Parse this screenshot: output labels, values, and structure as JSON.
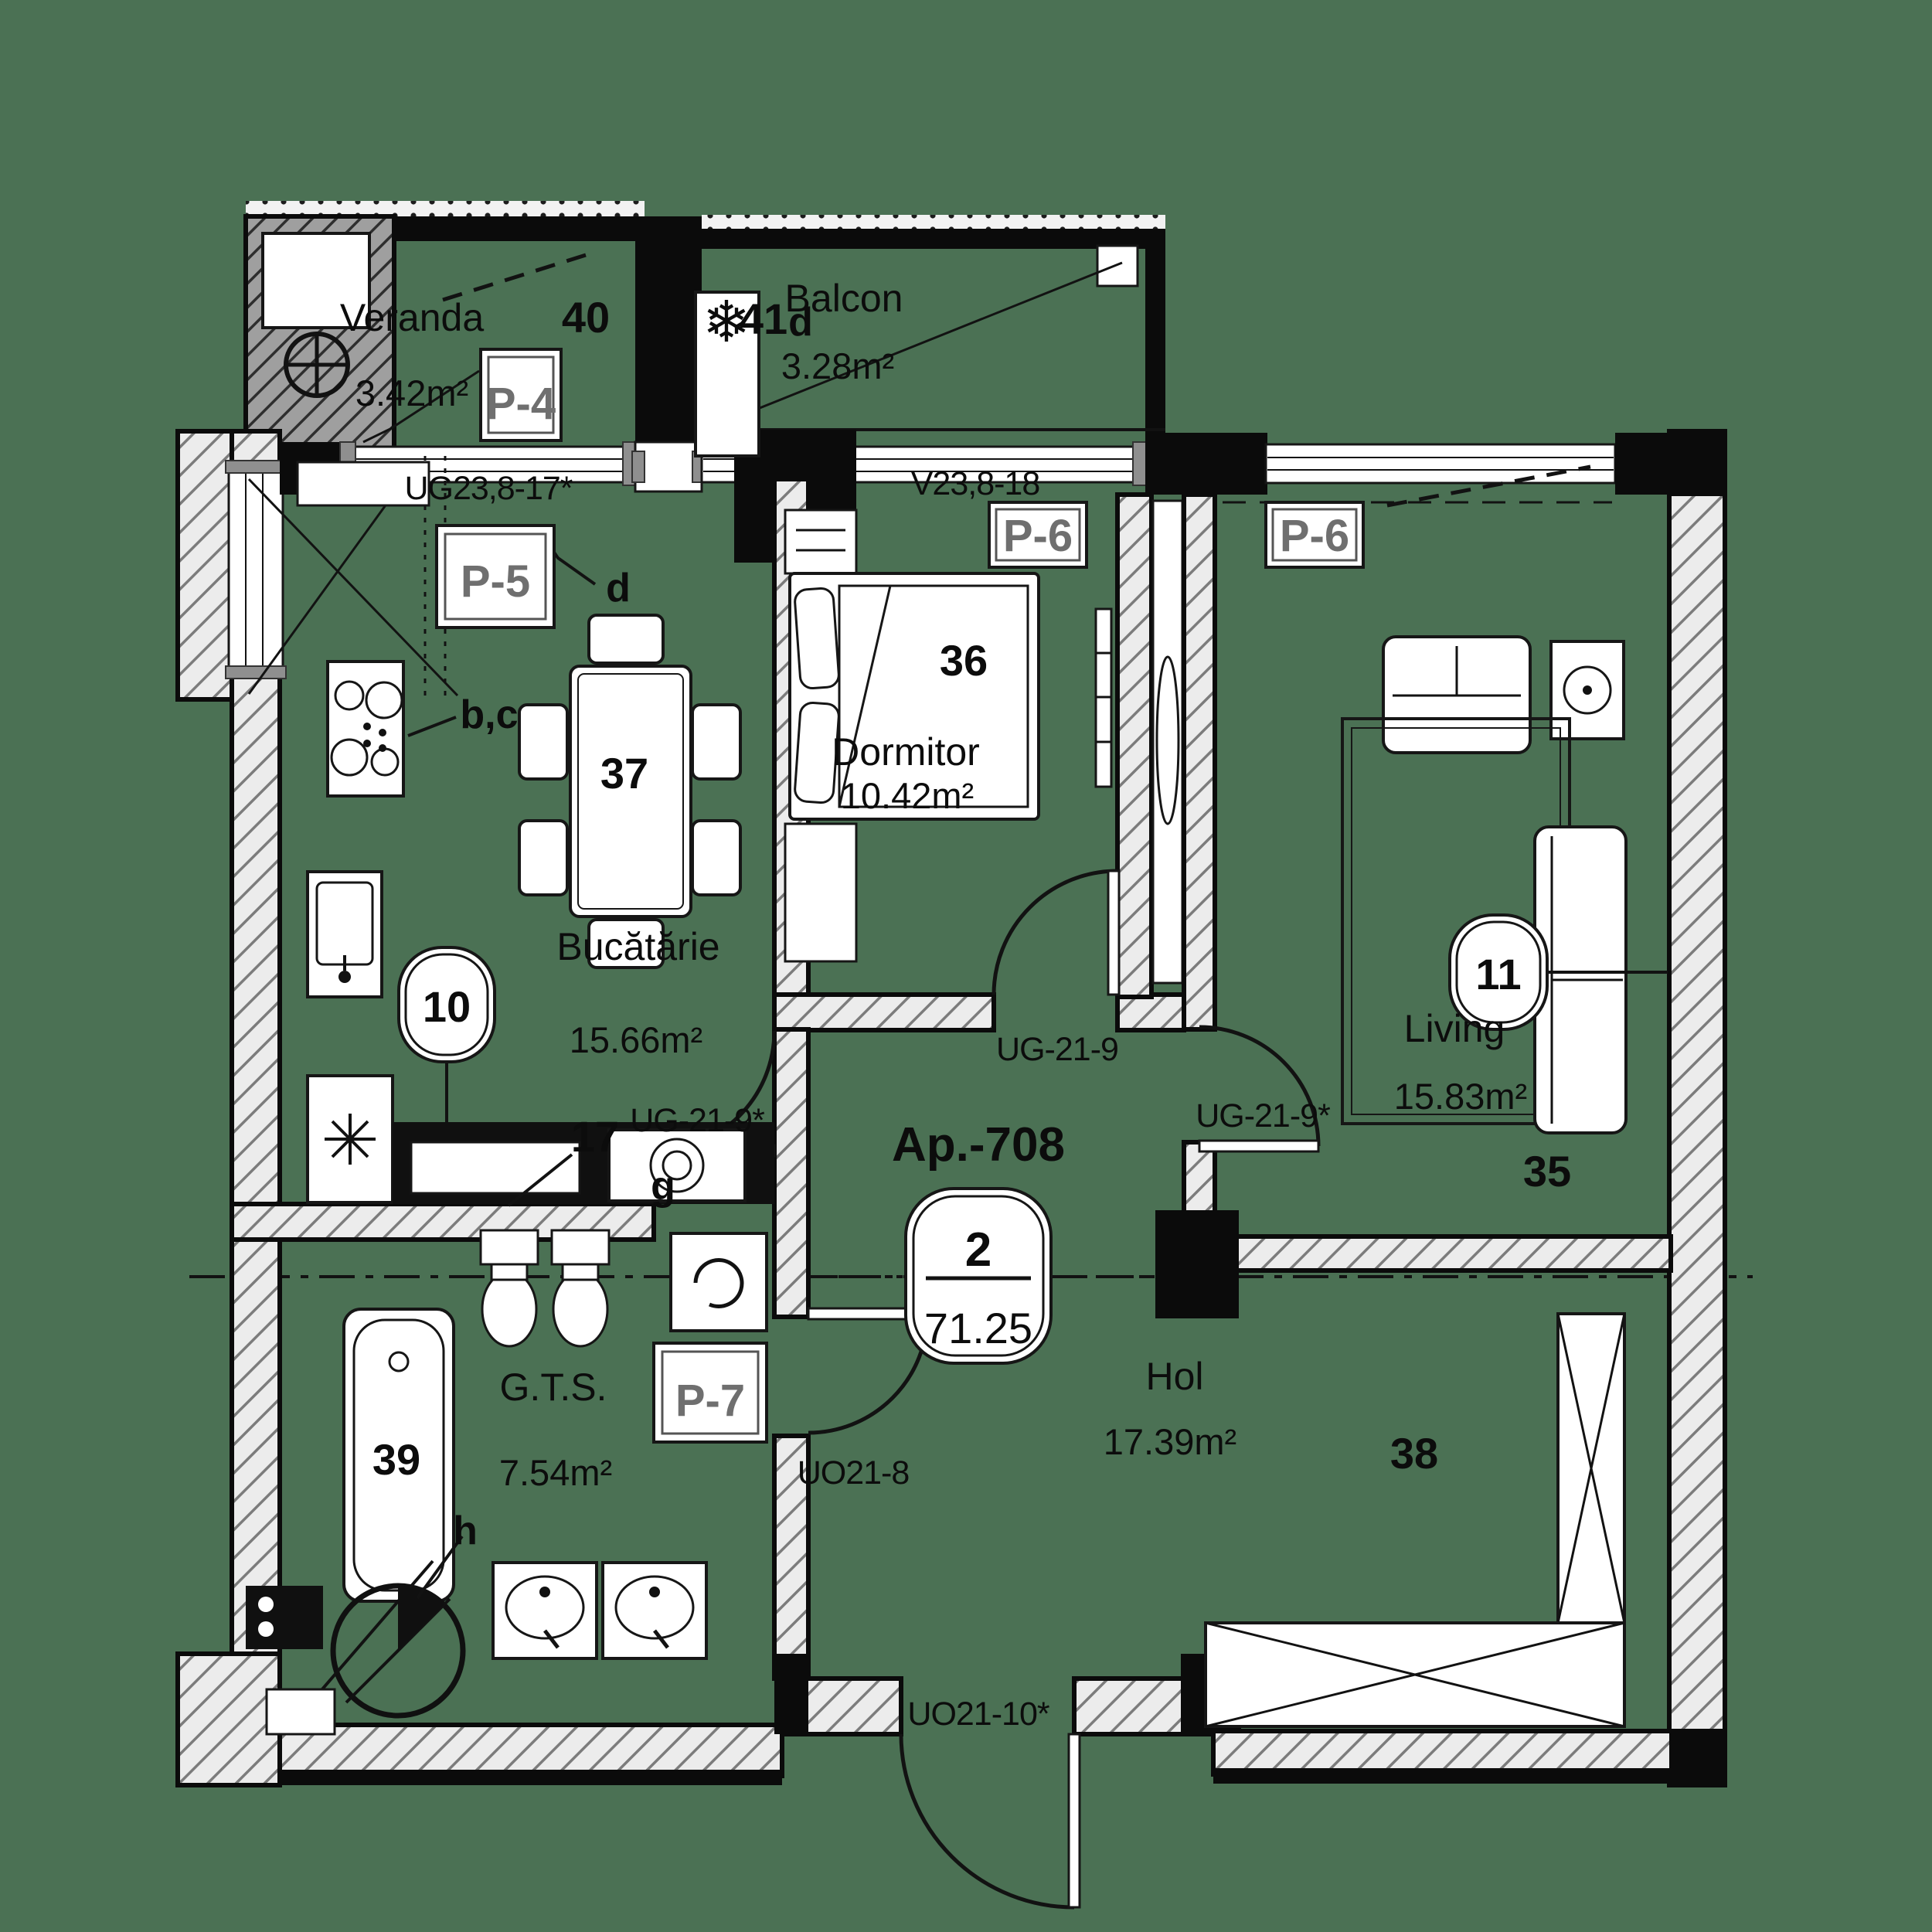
{
  "colors": {
    "background": "#4b7154",
    "ink": "#0c0c0c",
    "panel_text": "#6f6f6f"
  },
  "apartment_stamp": {
    "id": "Ap.-708",
    "rooms_count": "2",
    "total_area": "71.25"
  },
  "rooms": [
    {
      "name": "Veranda",
      "area": "3.42m²",
      "number": "40",
      "panel": "P-4"
    },
    {
      "name": "Balcon",
      "area": "3.28m²",
      "number": "41",
      "finish": "d"
    },
    {
      "name": "Bucătărie",
      "area": "15.66m²",
      "number": "37",
      "panel": "P-5",
      "tag": "10",
      "extra": "17",
      "finish_bc": "b,c",
      "finish_d": "d",
      "finish_g": "g"
    },
    {
      "name": "Dormitor",
      "area": "10.42m²",
      "number": "36",
      "panel": "P-6"
    },
    {
      "name": "Living",
      "area": "15.83m²",
      "number": "35",
      "panel": "P-6",
      "tag": "11"
    },
    {
      "name": "G.T.S.",
      "area": "7.54m²",
      "number": "39",
      "panel": "P-7",
      "finish": "h"
    },
    {
      "name": "Hol",
      "area": "17.39m²",
      "number": "38"
    }
  ],
  "window_labels": {
    "veranda": "UG23,8-17*",
    "balcony": "V23,8-18"
  },
  "door_labels": {
    "bedroom": "UG-21-9",
    "kitchen": "UG-21-9*",
    "living": "UG-21-9*",
    "bathroom": "UO21-8",
    "entrance": "UO21-10*"
  },
  "icons": {
    "snowflake": "❄"
  }
}
